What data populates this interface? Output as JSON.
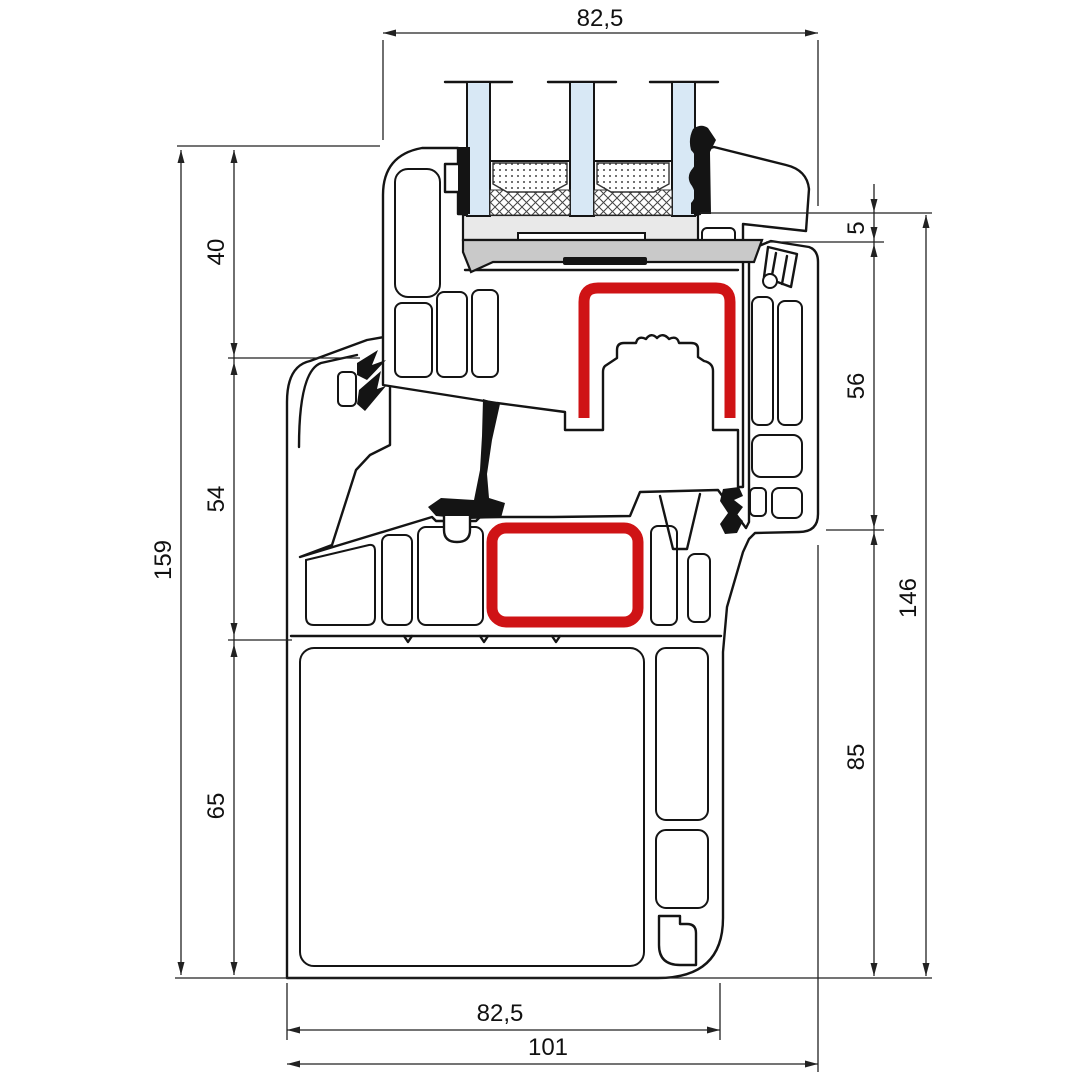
{
  "drawing": {
    "title": "window-profile-cross-section",
    "dims": {
      "top_overall": "82,5",
      "left": {
        "total": "159",
        "segments": [
          "40",
          "54",
          "65"
        ]
      },
      "right": {
        "segments": [
          "5",
          "56",
          "85"
        ],
        "total": "146"
      },
      "bottom": {
        "inner": "82,5",
        "overall": "101"
      }
    },
    "colors": {
      "reinforcement_red": "#cf1315",
      "glass_blue": "#d8e8f5",
      "bed_light_gray": "#e9e9e9",
      "bed_dark_gray": "#c9c9c9",
      "line_black": "#141414",
      "background": "#ffffff"
    }
  }
}
